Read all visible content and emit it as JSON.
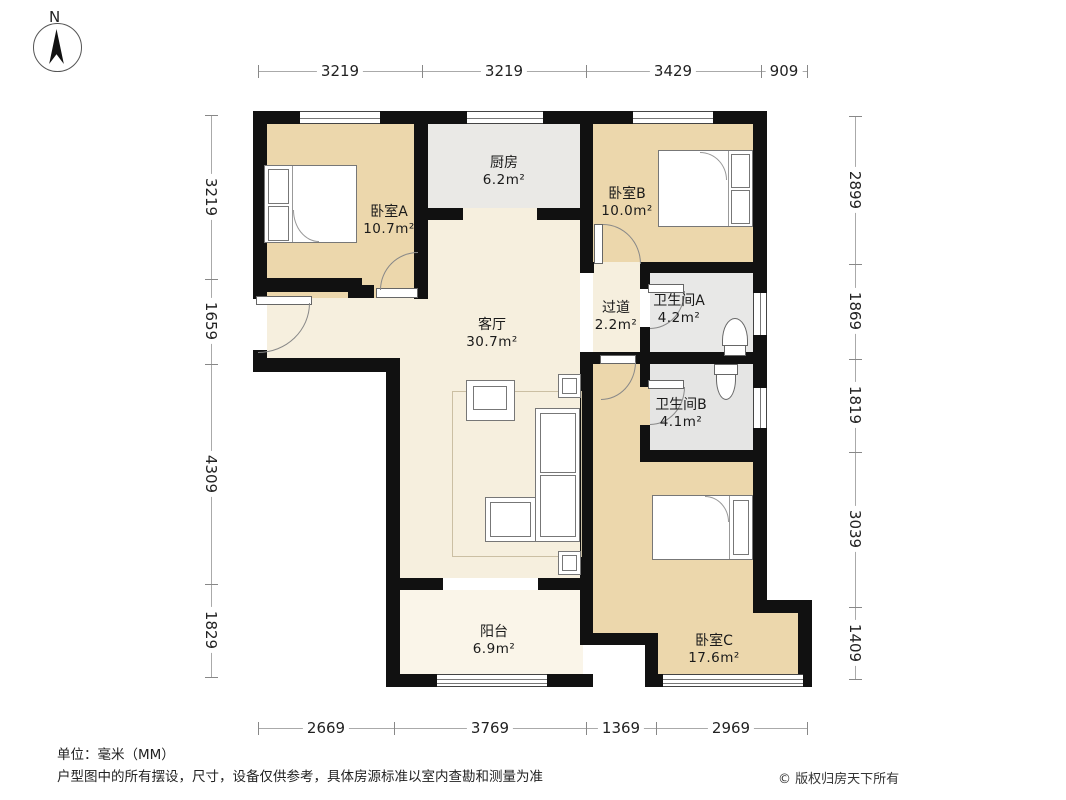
{
  "compass": {
    "north_label": "N"
  },
  "dims": {
    "top": [
      "3219",
      "3219",
      "3429",
      "909"
    ],
    "bottom": [
      "2669",
      "3769",
      "1369",
      "2969"
    ],
    "left": [
      "3219",
      "1659",
      "4309",
      "1829"
    ],
    "right": [
      "2899",
      "1869",
      "1819",
      "3039",
      "1409"
    ]
  },
  "rooms": {
    "bedroomA": {
      "name": "卧室A",
      "area": "10.7m²"
    },
    "kitchen": {
      "name": "厨房",
      "area": "6.2m²"
    },
    "bedroomB": {
      "name": "卧室B",
      "area": "10.0m²"
    },
    "corridor": {
      "name": "过道",
      "area": "2.2m²"
    },
    "bathroomA": {
      "name": "卫生间A",
      "area": "4.2m²"
    },
    "bathroomB": {
      "name": "卫生间B",
      "area": "4.1m²"
    },
    "living": {
      "name": "客厅",
      "area": "30.7m²"
    },
    "balcony": {
      "name": "阳台",
      "area": "6.9m²"
    },
    "bedroomC": {
      "name": "卧室C",
      "area": "17.6m²"
    }
  },
  "footer": {
    "unit": "单位：毫米（MM）",
    "disclaimer": "户型图中的所有摆设，尺寸，设备仅供参考，具体房源标准以室内查勘和测量为准",
    "copyright": "© 版权归房天下所有"
  },
  "colors": {
    "wall": "#111111",
    "bedroom": "#ecd7ac",
    "living": "#f6efde",
    "balcony": "#faf5e9",
    "kitchen": "#eae9e6",
    "bathroom": "#e8e8e7"
  }
}
